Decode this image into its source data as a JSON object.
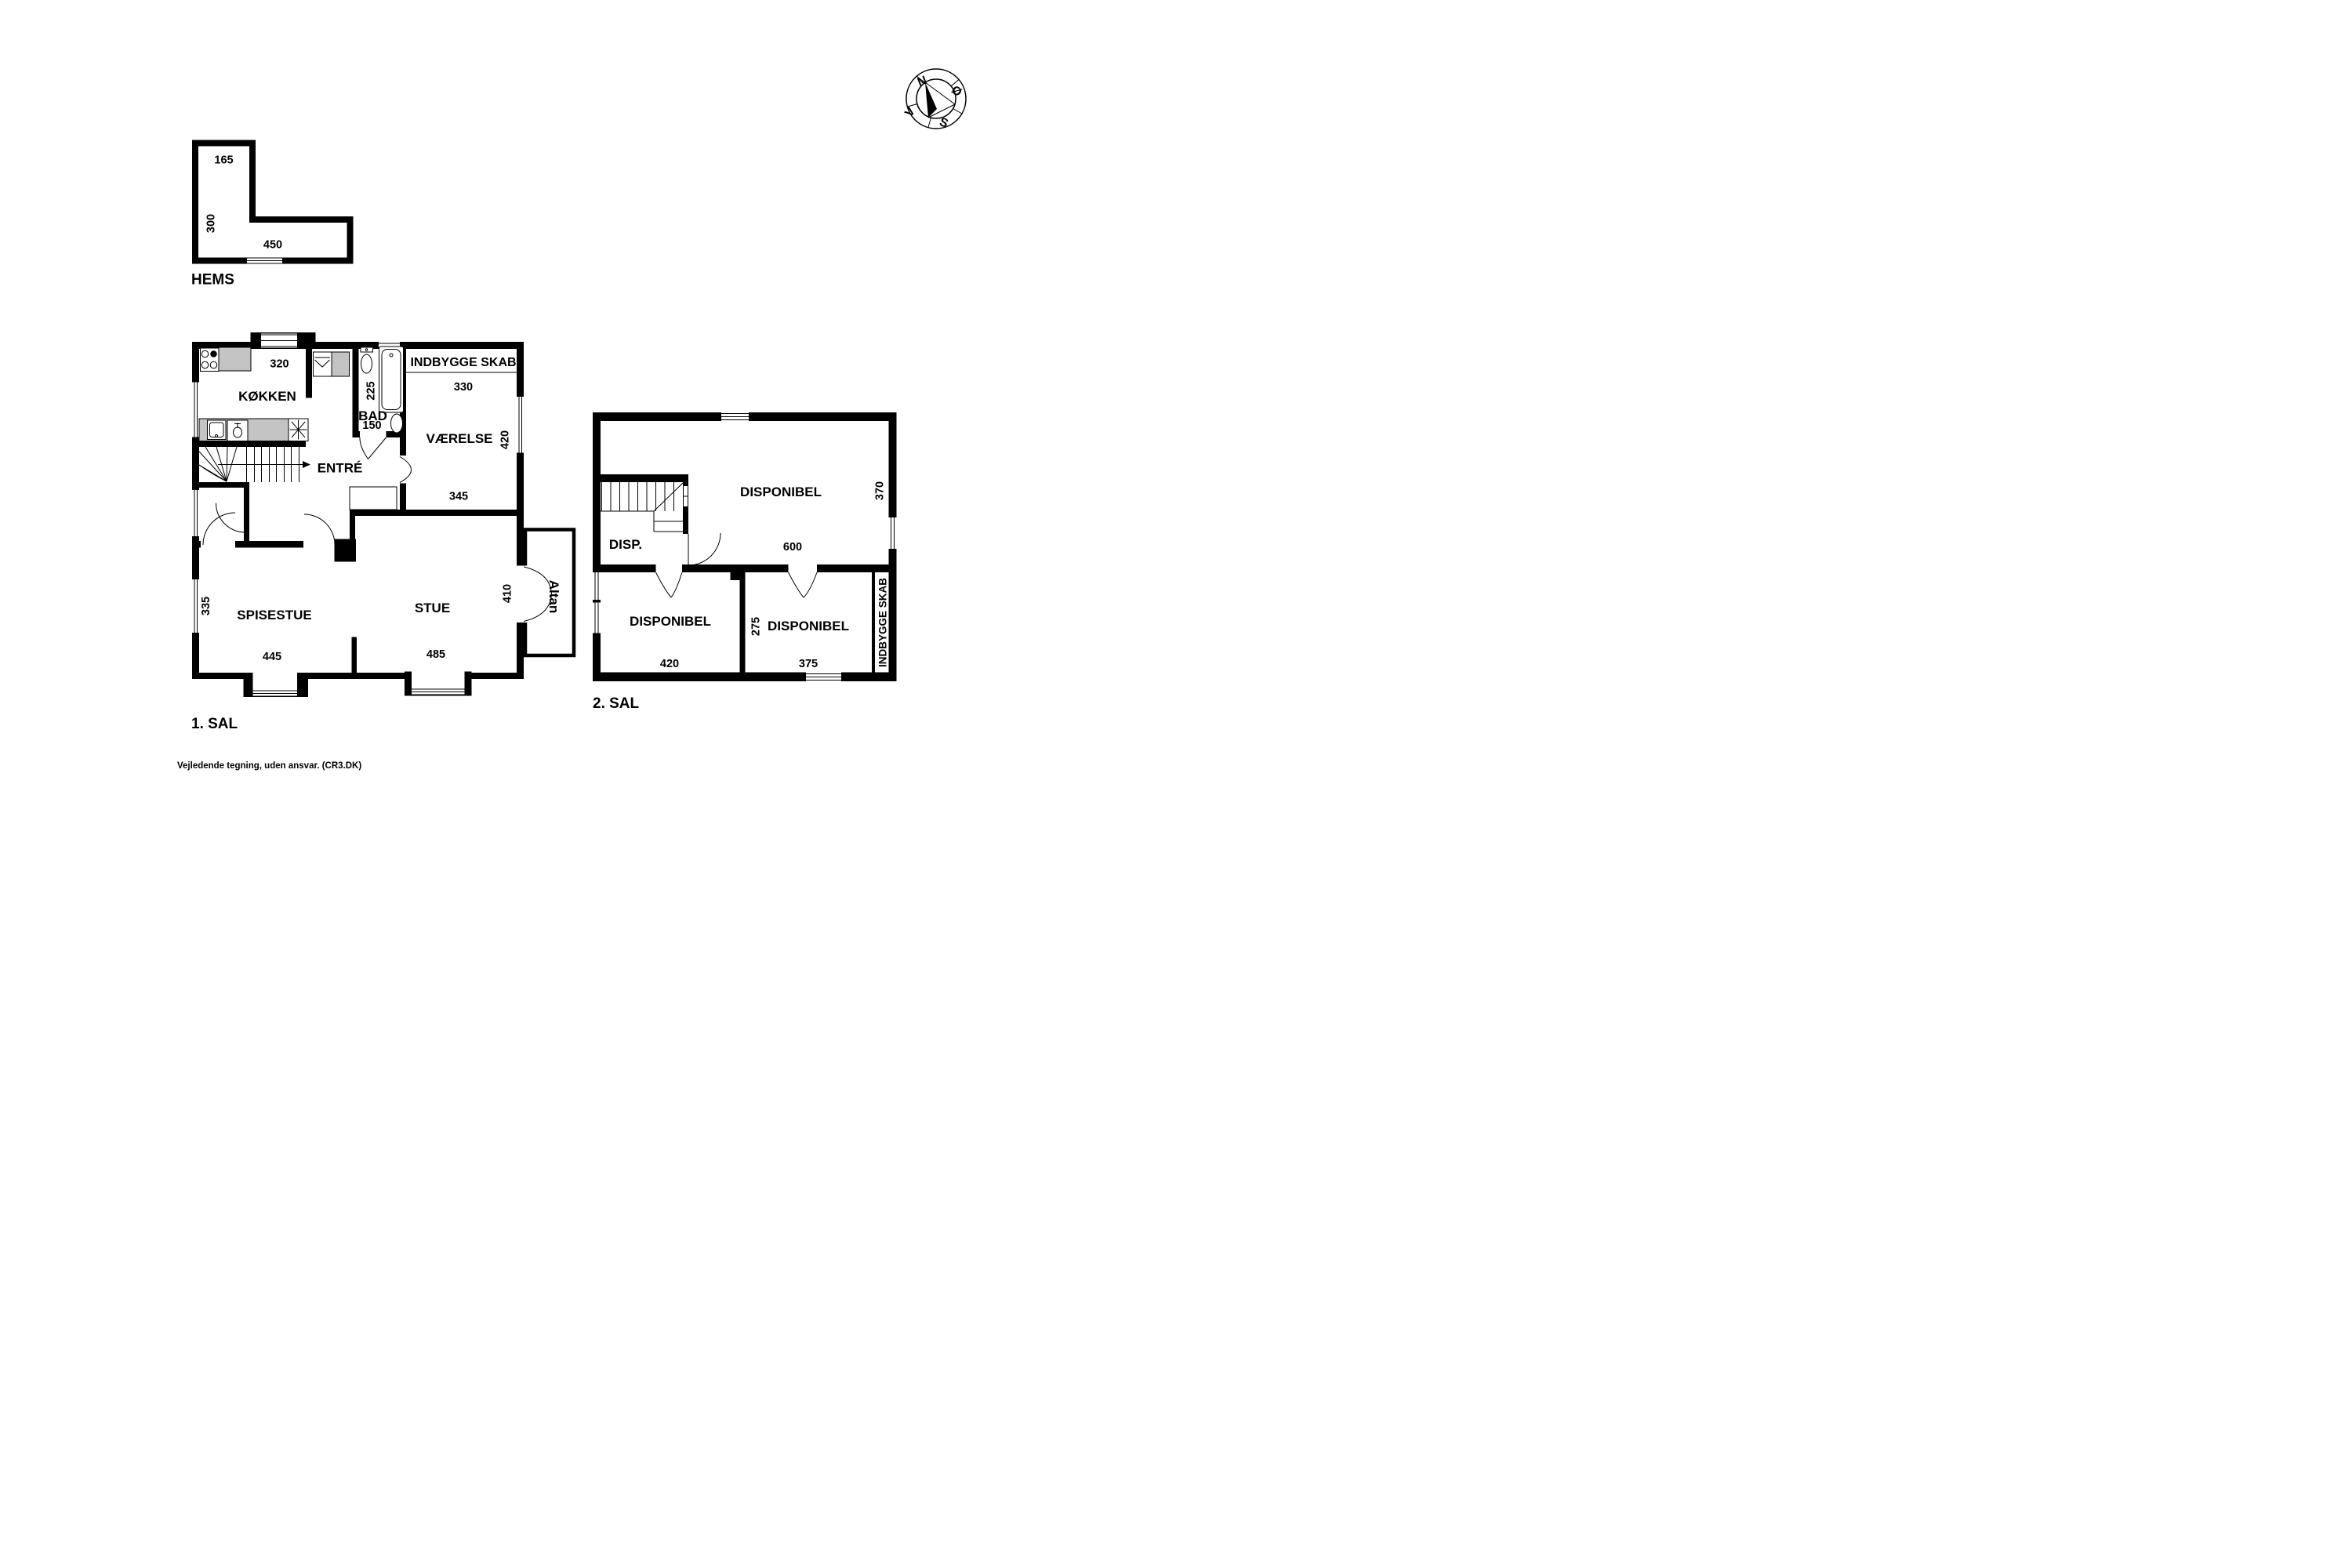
{
  "colors": {
    "background": "#ffffff",
    "wall": "#000000",
    "counter_gray": "#c3c3c3"
  },
  "compass": {
    "north": "N",
    "east": "Ø",
    "south": "S",
    "west": "V"
  },
  "hems": {
    "title": "HEMS",
    "dim_top": "165",
    "dim_left": "300",
    "dim_bottom": "450"
  },
  "sal1": {
    "title": "1. SAL",
    "kokken": {
      "label": "KØKKEN",
      "dim_top": "320"
    },
    "bad": {
      "label": "BAD",
      "dim_left": "225",
      "dim_bottom": "150"
    },
    "indbygge_skab": {
      "label": "INDBYGGE SKAB"
    },
    "vaerelse": {
      "label": "VÆRELSE",
      "dim_top": "330",
      "dim_right": "420",
      "dim_bottom": "345"
    },
    "entre": {
      "label": "ENTRÉ"
    },
    "spisestue": {
      "label": "SPISESTUE",
      "dim_left": "335",
      "dim_bottom": "445"
    },
    "stue": {
      "label": "STUE",
      "dim_right": "410",
      "dim_bottom": "485"
    },
    "altan": {
      "label": "Altan"
    }
  },
  "sal2": {
    "title": "2. SAL",
    "disp": {
      "label": "DISP."
    },
    "disponibel_main": {
      "label": "DISPONIBEL",
      "dim_bottom": "600",
      "dim_right": "370"
    },
    "disponibel_left": {
      "label": "DISPONIBEL",
      "dim_bottom": "420"
    },
    "disponibel_right": {
      "label": "DISPONIBEL",
      "dim_left": "275",
      "dim_bottom": "375"
    },
    "indbygge_skab": {
      "label": "INDBYGGE SKAB"
    }
  },
  "footer": {
    "disclaimer": "Vejledende tegning, uden ansvar. (CR3.DK)"
  }
}
